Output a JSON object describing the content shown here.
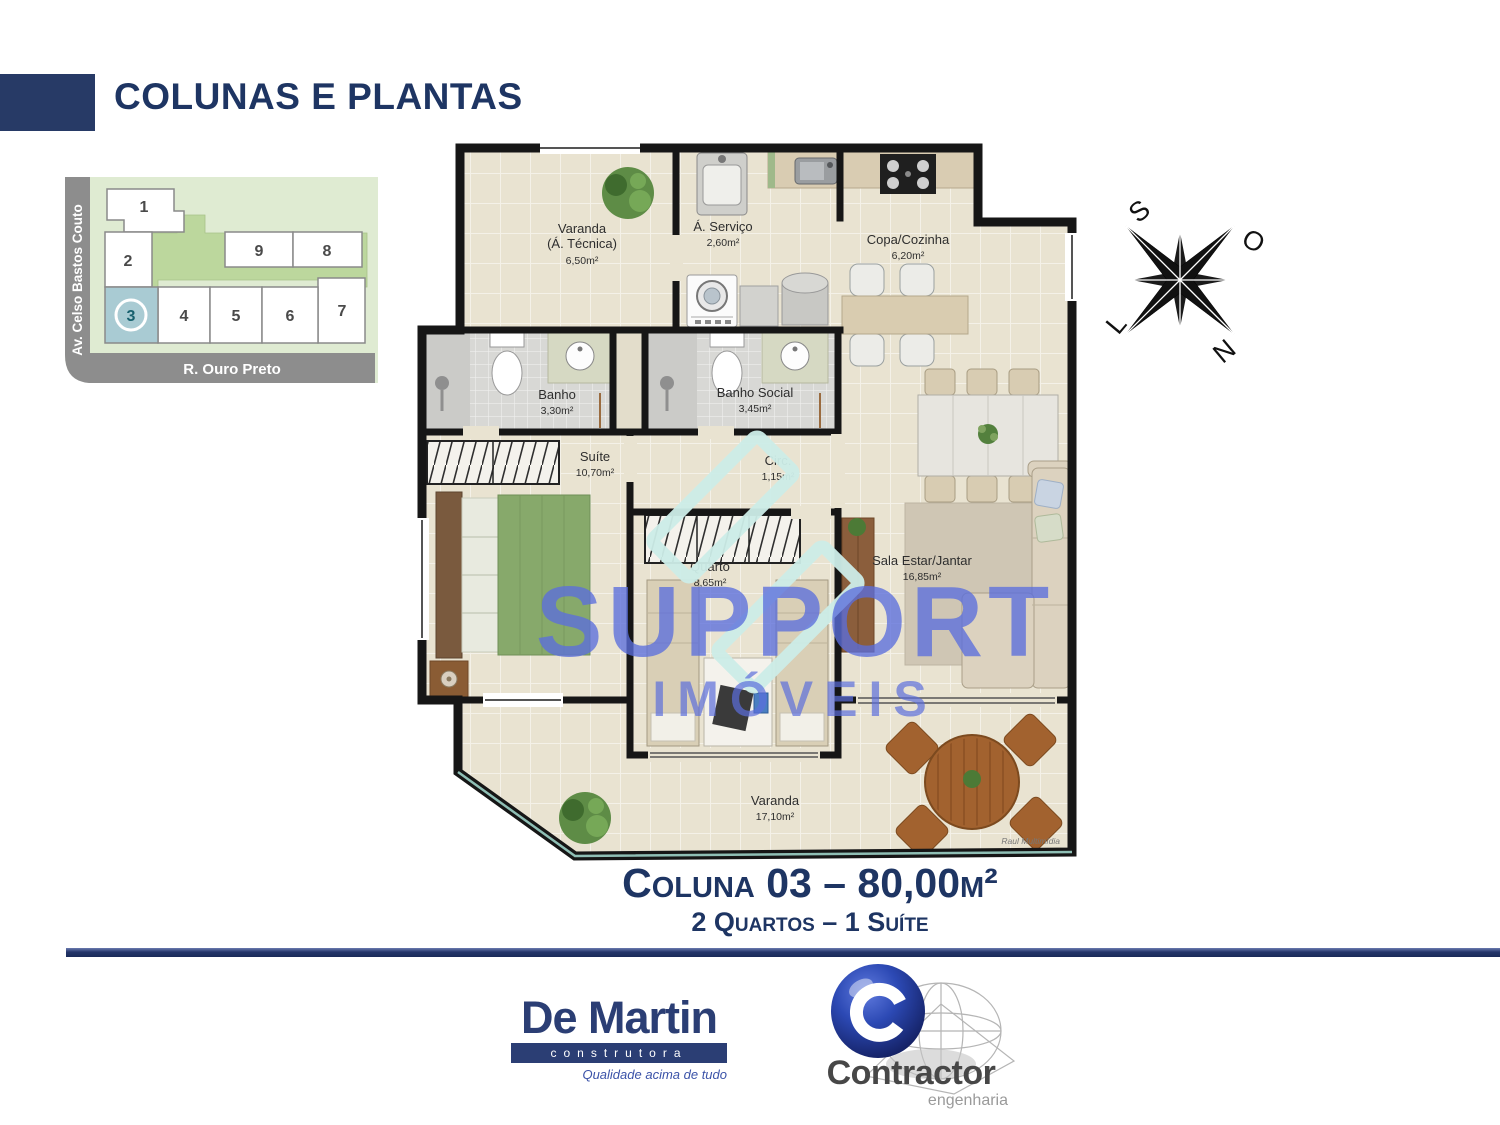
{
  "title": "COLUNAS E PLANTAS",
  "site_map": {
    "street_left": "Av. Celso Bastos Couto",
    "street_bottom": "R. Ouro Preto",
    "units": [
      "1",
      "2",
      "3",
      "4",
      "5",
      "6",
      "7",
      "8",
      "9"
    ],
    "highlighted_unit": "3"
  },
  "compass": {
    "s": "S",
    "o": "O",
    "l": "L",
    "n": "N"
  },
  "plan": {
    "rooms": [
      {
        "name": "Varanda",
        "line2": "(Á. Técnica)",
        "area": "6,50m²"
      },
      {
        "name": "Á. Serviço",
        "area": "2,60m²"
      },
      {
        "name": "Copa/Cozinha",
        "area": "6,20m²"
      },
      {
        "name": "Banho",
        "area": "3,30m²"
      },
      {
        "name": "Banho Social",
        "area": "3,45m²"
      },
      {
        "name": "Suíte",
        "area": "10,70m²"
      },
      {
        "name": "Circ.",
        "area": "1,15m²"
      },
      {
        "name": "Quarto",
        "area": "8,65m²"
      },
      {
        "name": "Sala Estar/Jantar",
        "area": "16,85m²"
      },
      {
        "name": "Varanda",
        "area": "17,10m²"
      }
    ],
    "signature": "Raul Multimídia"
  },
  "watermark": {
    "line1": "SUPPORT",
    "line2": "IMÓVEIS"
  },
  "caption": {
    "line1": "Coluna 03 – 80,00m²",
    "line2": "2 Quartos – 1 Suíte"
  },
  "logos": {
    "demartin": {
      "name": "De Martin",
      "sub": "construtora",
      "tagline": "Qualidade acima de tudo"
    },
    "contractor": {
      "name": "Contractor",
      "sub": "engenharia"
    }
  },
  "colors": {
    "navy": "#1E3563",
    "watermark_blue": "#5B6EDC",
    "highlight_unit": "#A9CBD3",
    "plan_floor": "#E9E3D1"
  }
}
